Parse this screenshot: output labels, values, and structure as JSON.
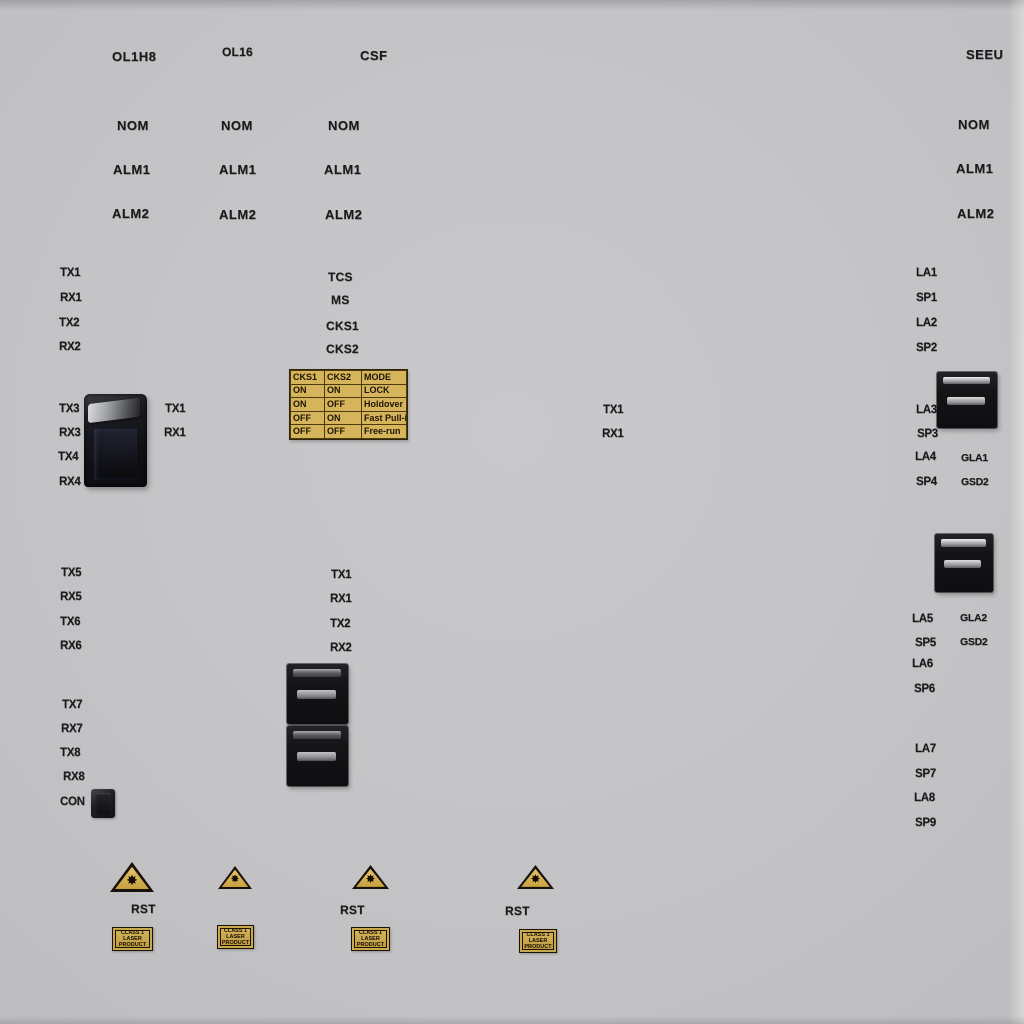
{
  "colors": {
    "panel": "#c6c6c8",
    "label_text": "#1a1a1c",
    "table_bg": "#d6b45c",
    "table_border": "#4b3a0e",
    "sticker_bg": "#c9a84e",
    "triangle_fill": "#d8b65c",
    "connector_body": "#141417"
  },
  "header": {
    "ol1h8": "OL1H8",
    "ol16": "OL16",
    "csf": "CSF",
    "seeu": "SEEU"
  },
  "led_columns": [
    {
      "items": [
        "NOM",
        "ALM1",
        "ALM2"
      ]
    },
    {
      "items": [
        "NOM",
        "ALM1",
        "ALM2"
      ]
    },
    {
      "items": [
        "NOM",
        "ALM1",
        "ALM2"
      ]
    },
    {
      "items": [
        "NOM",
        "ALM1",
        "ALM2"
      ]
    }
  ],
  "ports": {
    "left_top": [
      "TX1",
      "RX1",
      "TX2",
      "RX2"
    ],
    "center_status": [
      "TCS",
      "MS",
      "CKS1",
      "CKS2"
    ],
    "left_block": [
      "TX3",
      "RX3",
      "TX4",
      "RX4"
    ],
    "left_block_aux": [
      "TX1",
      "RX1"
    ],
    "mid_aux": [
      "TX1",
      "RX1"
    ],
    "right_top": [
      "LA1",
      "SP1",
      "LA2",
      "SP2"
    ],
    "right_block1": [
      "LA3",
      "SP3",
      "LA4",
      "SP4"
    ],
    "right_block1_aux": [
      "GLA1",
      "GSD2"
    ],
    "right_block2": [
      "LA5",
      "SP5",
      "LA6",
      "SP6"
    ],
    "right_block2_aux": [
      "GLA2",
      "GSD2"
    ],
    "right_bottom": [
      "LA7",
      "SP7",
      "LA8",
      "SP9"
    ],
    "mid_left": [
      "TX5",
      "RX5",
      "TX6",
      "RX6"
    ],
    "mid_center": [
      "TX1",
      "RX1",
      "TX2",
      "RX2"
    ],
    "bottom_left": [
      "TX7",
      "RX7",
      "TX8",
      "RX8"
    ],
    "console_label": "CON"
  },
  "cks_table": {
    "headers": [
      "CKS1",
      "CKS2",
      "MODE"
    ],
    "rows": [
      [
        "ON",
        "ON",
        "LOCK"
      ],
      [
        "ON",
        "OFF",
        "Holdover"
      ],
      [
        "OFF",
        "ON",
        "Fast Pull-in"
      ],
      [
        "OFF",
        "OFF",
        "Free-run"
      ]
    ]
  },
  "laser_modules": [
    {
      "rst": "RST",
      "sticker_lines": [
        "CLASS 1",
        "LASER",
        "PRODUCT"
      ]
    },
    {
      "sticker_lines": [
        "CLASS 1",
        "LASER",
        "PRODUCT"
      ]
    },
    {
      "rst": "RST",
      "sticker_lines": [
        "CLASS 1",
        "LASER",
        "PRODUCT"
      ]
    },
    {
      "rst": "RST",
      "sticker_lines": [
        "CLASS 1",
        "LASER",
        "PRODUCT"
      ]
    }
  ]
}
